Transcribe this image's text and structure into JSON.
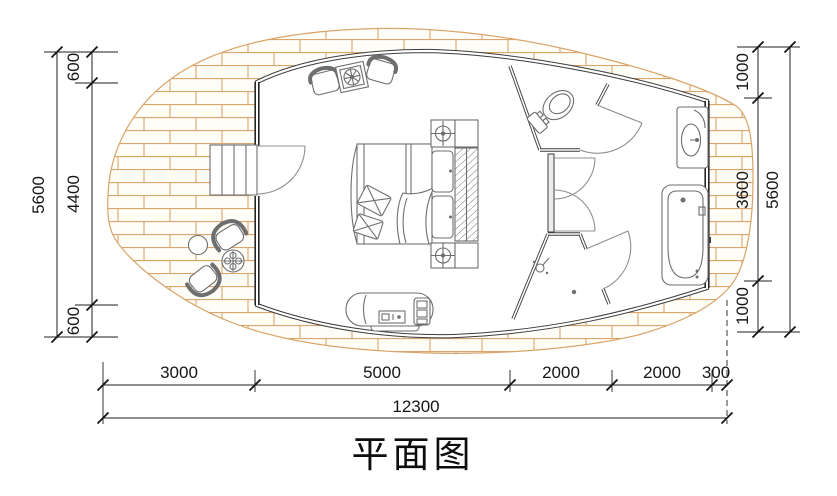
{
  "title": "平面图",
  "dims": {
    "left": {
      "total": "5600",
      "segments": [
        "600",
        "4400",
        "600"
      ]
    },
    "right": {
      "total": "5600",
      "segments": [
        "1000",
        "3600",
        "1000"
      ]
    },
    "bottom": {
      "total": "12300",
      "segments": [
        "3000",
        "5000",
        "2000",
        "2000",
        "300"
      ]
    }
  },
  "colors": {
    "brick": "#d9a469",
    "wall": "#3b3b3b",
    "furniture": "#6e6e6e",
    "dimension": "#1f1f1f"
  },
  "furniture_icons": [
    "entry-steps",
    "entry-door",
    "armchair",
    "side-table",
    "double-bed",
    "pillow",
    "blanket",
    "nightstand-lamp",
    "wardrobe-hanging-clothes",
    "sofa-bench",
    "toilet",
    "washbasin-vanity",
    "bathtub",
    "shower-head",
    "floor-drain",
    "outdoor-tub-chair",
    "outdoor-round-table",
    "brick-deck"
  ]
}
